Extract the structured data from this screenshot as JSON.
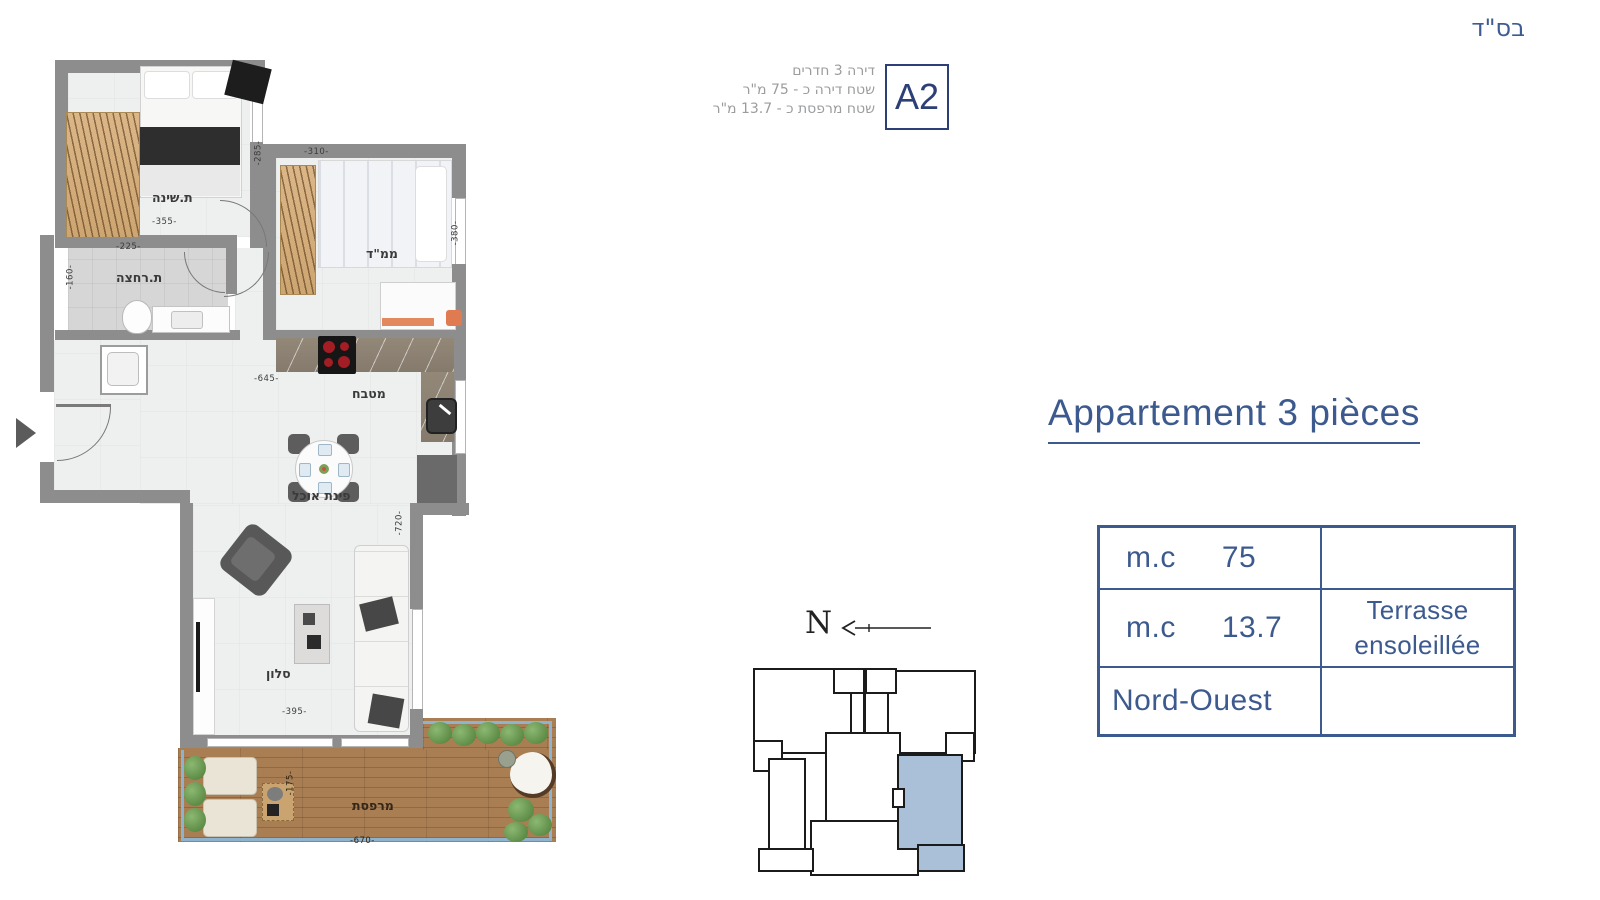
{
  "meta": {
    "bsd": "בס\"ד"
  },
  "header": {
    "lines": [
      "דירה 3 חדרים",
      "שטח דירה כ - 75 מ\"ר",
      "שטח מרפסת כ - 13.7 מ\"ר"
    ],
    "badge": "A2"
  },
  "title": {
    "text": "Appartement 3 pièces"
  },
  "spec_table": {
    "rows": [
      {
        "label": "m.c",
        "value": "75",
        "note": ""
      },
      {
        "label": "m.c",
        "value": "13.7",
        "note": "Terrasse ensoleillée"
      },
      {
        "label": "Nord-Ouest",
        "value": "",
        "note": ""
      }
    ]
  },
  "floorplan": {
    "labels": {
      "bedroom": "ת.שינה",
      "safe_room": "ממ\"ד",
      "bathroom": "ת.רחצה",
      "kitchen": "מטבח",
      "dining": "פינת אוכל",
      "living": "סלון",
      "terrace": "מרפסת"
    },
    "dimensions": {
      "bedroom_w": "-355-",
      "bedroom_h": "-285-",
      "safe_room_w": "-310-",
      "safe_room_h": "-380-",
      "bathroom_w": "-225-",
      "bathroom_h": "-160-",
      "kitchen_w": "-645-",
      "living_w": "-395-",
      "living_h": "-720-",
      "terrace_w": "-670-",
      "terrace_h": "-175-"
    }
  },
  "compass": {
    "north": "N"
  },
  "colors": {
    "accent_blue": "#3d5a8f",
    "badge_navy": "#2c3f77",
    "unit_fill": "#a9c0d8",
    "wall_gray": "#8d8d8d",
    "deck_wood": "#a97e52",
    "plant_green": "#6a9c53"
  }
}
